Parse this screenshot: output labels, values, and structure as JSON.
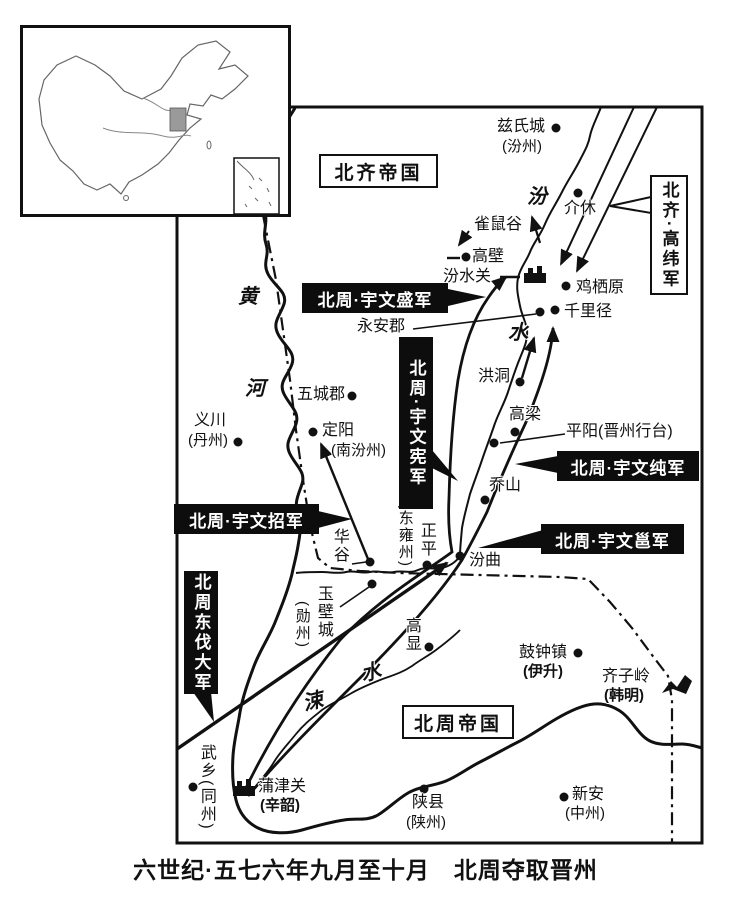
{
  "caption": "六世纪·五七六年九月至十月　北周夺取晋州",
  "empires": {
    "north_qi": "北齐帝国",
    "north_zhou": "北周帝国"
  },
  "armies": {
    "gaowei": "北齐·高纬军",
    "yuwensheng": "北周·宇文盛军",
    "yuwenxian": "北周·宇文宪军",
    "yuwenzhao": "北周·宇文招军",
    "dongfa": "北周东伐大军",
    "yuwenchun": "北周·宇文纯军",
    "yuwenyong": "北周·宇文邕军"
  },
  "rivers": {
    "huang": "黄",
    "he": "河",
    "fen": "汾",
    "fen_shui": "水",
    "su": "涑",
    "su_shui": "水"
  },
  "places": {
    "cishicheng": "兹氏城",
    "cishicheng_sub": "(汾州)",
    "jiexiu": "介休",
    "queshugu": "雀鼠谷",
    "gaobi": "高壁",
    "fenshuiguan": "汾水关",
    "jiqiyuan": "鸡栖原",
    "qianlijing": "千里径",
    "yonganjun": "永安郡",
    "hongtong": "洪洞",
    "gaoliang": "高梁",
    "pingyang": "平阳(晋州行台)",
    "qiaoshan": "乔山",
    "wuchengjun": "五城郡",
    "dingyang": "定阳",
    "dingyang_sub": "(南汾州)",
    "yichuan": "义川",
    "yichuan_sub": "(丹州)",
    "huagu": "华谷",
    "zhengping": "正平",
    "dongyongzhou": "(东雍州)",
    "fenqu": "汾曲",
    "yubicheng": "玉壁城",
    "xunzhou": "(勋州)",
    "gaoxian": "高显",
    "guzhongzhen": "鼓钟镇",
    "guzhongzhen_sub": "(伊升)",
    "qiziling": "齐子岭",
    "qiziling_sub": "(韩明)",
    "xinan": "新安",
    "xinan_sub": "(中州)",
    "shanxian": "陕县",
    "shanxian_sub": "(陕州)",
    "pujinguan": "蒲津关",
    "pujinguan_sub": "(辛韶)",
    "wuxiang": "武乡(同州)"
  },
  "colors": {
    "ink": "#111111",
    "paper": "#ffffff",
    "locator_shade": "#9a9a9a"
  }
}
